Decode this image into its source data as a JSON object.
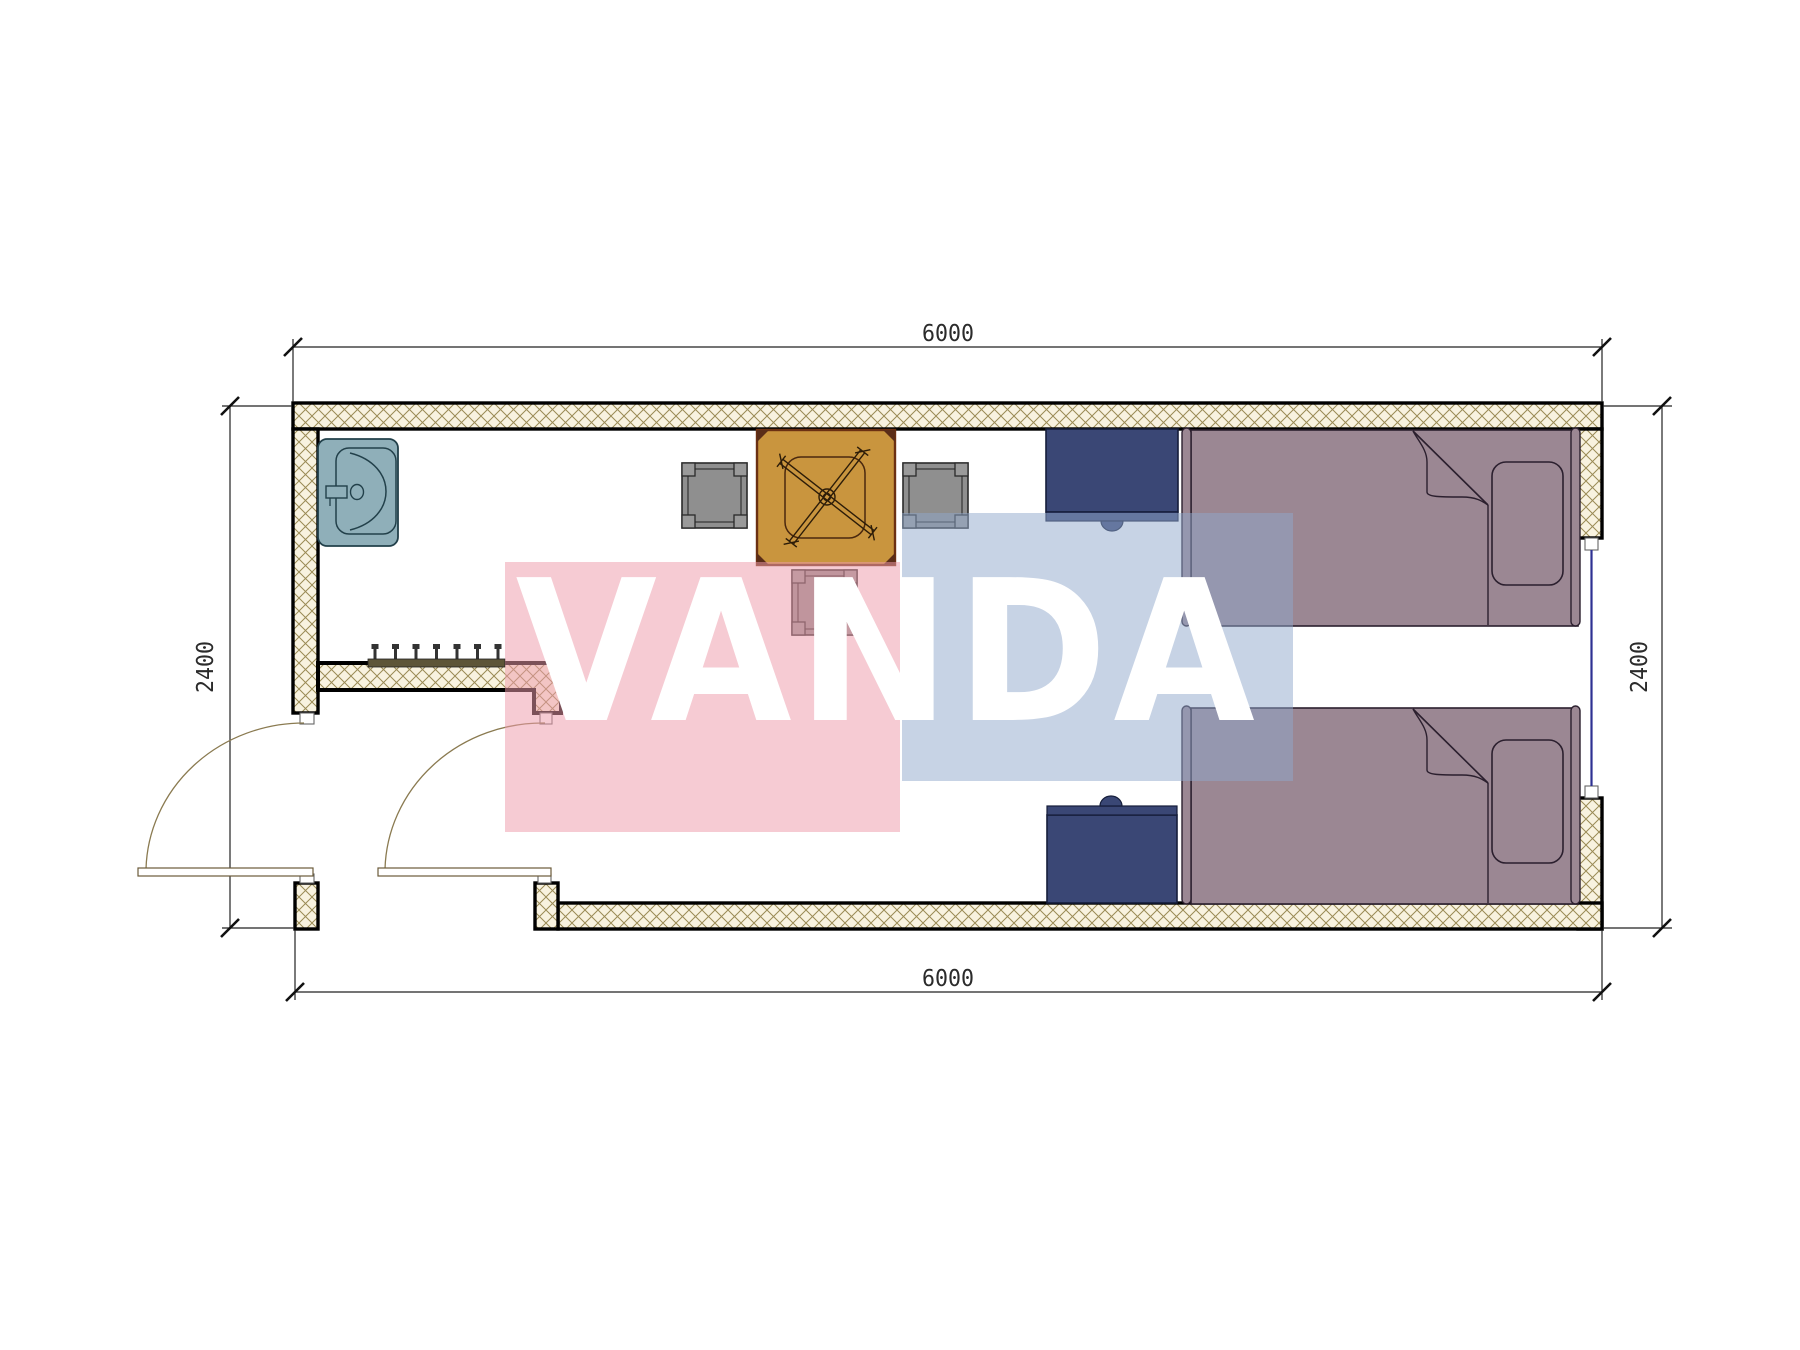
{
  "title": "floor-plan-drawing",
  "watermark": {
    "text": "VANDA"
  },
  "dimensions": {
    "top": "6000",
    "bottom": "6000",
    "left": "2400",
    "right": "2400"
  },
  "colors": {
    "paper": "#ffffff",
    "wall_outline": "#000000",
    "hatch_bg": "#f8f2df",
    "hatch_line": "#9a8a55",
    "dim_line": "#222222",
    "jamb_stroke": "#666666",
    "window_glass": "#2e3192",
    "door_arc": "#8a7a50",
    "door_leaf_stroke": "#6b5b3a",
    "sink_fill": "#8fafb9",
    "sink_stroke": "#22404a",
    "table_fill": "#c9953e",
    "table_stroke": "#6b3012",
    "table_inner": "#4a280e",
    "chair_fill": "#8f8f8f",
    "chair_post": "#9a9a9a",
    "chair_stroke": "#2a2a2a",
    "bed_fill": "#9b8793",
    "bed_stroke": "#2b1f2e",
    "nightstand_fill": "#3a4775",
    "nightstand_stroke": "#151d3a",
    "rack_fill": "#5d5538",
    "rack_hook": "#333333",
    "watermark_pink": "#ee9cab",
    "watermark_blue": "#8fa8cc",
    "watermark_text": "#ffffff"
  }
}
